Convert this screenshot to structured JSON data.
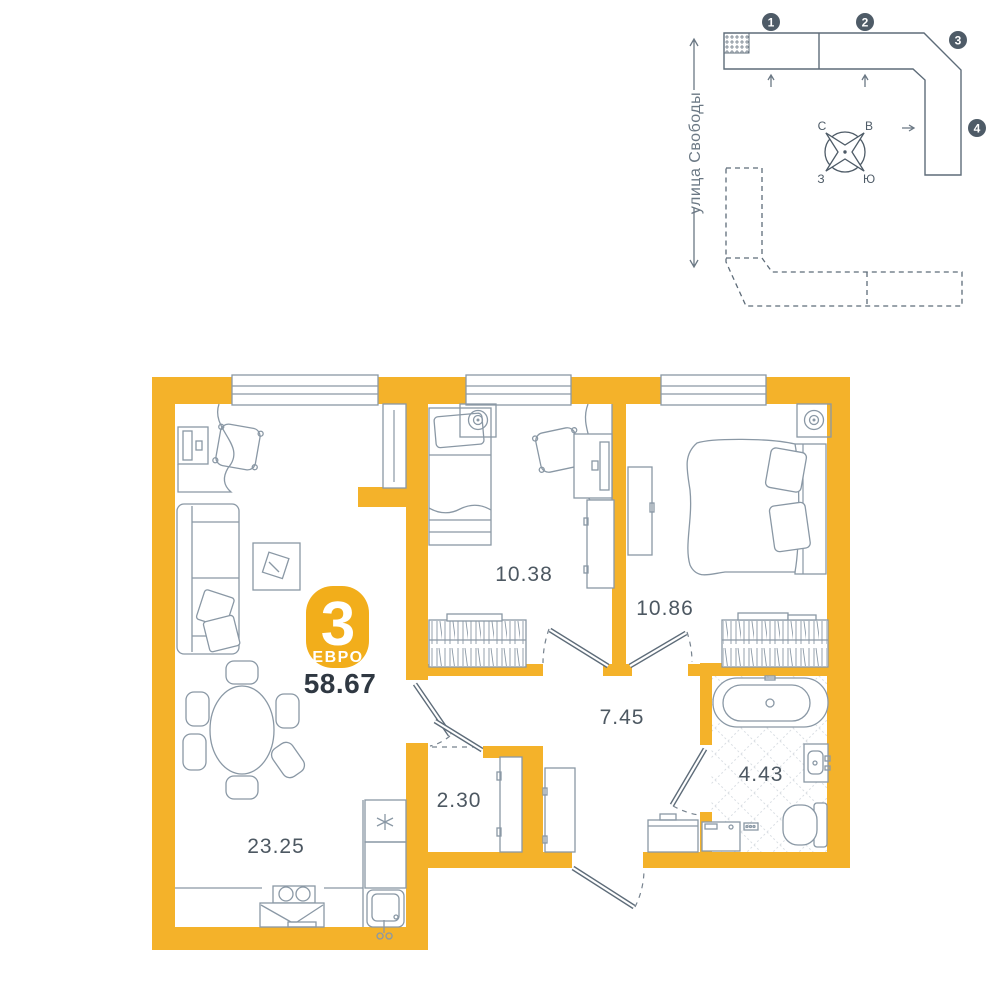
{
  "apartment": {
    "badge_rooms": "3",
    "badge_type": "ЕВРО",
    "total_area": "58.67",
    "rooms": [
      {
        "id": "living-kitchen",
        "area": "23.25"
      },
      {
        "id": "bedroom-small",
        "area": "10.38"
      },
      {
        "id": "bedroom-master",
        "area": "10.86"
      },
      {
        "id": "hallway",
        "area": "7.45"
      },
      {
        "id": "bathroom",
        "area": "4.43"
      },
      {
        "id": "storage",
        "area": "2.30"
      }
    ]
  },
  "site": {
    "street_label": "улица Свободы",
    "building_markers": [
      "1",
      "2",
      "3",
      "4"
    ],
    "compass": {
      "north": "С",
      "east": "В",
      "west": "З",
      "south": "Ю"
    }
  },
  "colors": {
    "wall": "#F4B22A",
    "badge": "#F2AE1B",
    "furniture_outline": "#8A98A5",
    "site_outline": "#5E6C79",
    "marker": "#4E5B67",
    "area_label": "#4D5862",
    "total_area_text": "#2F3842"
  }
}
